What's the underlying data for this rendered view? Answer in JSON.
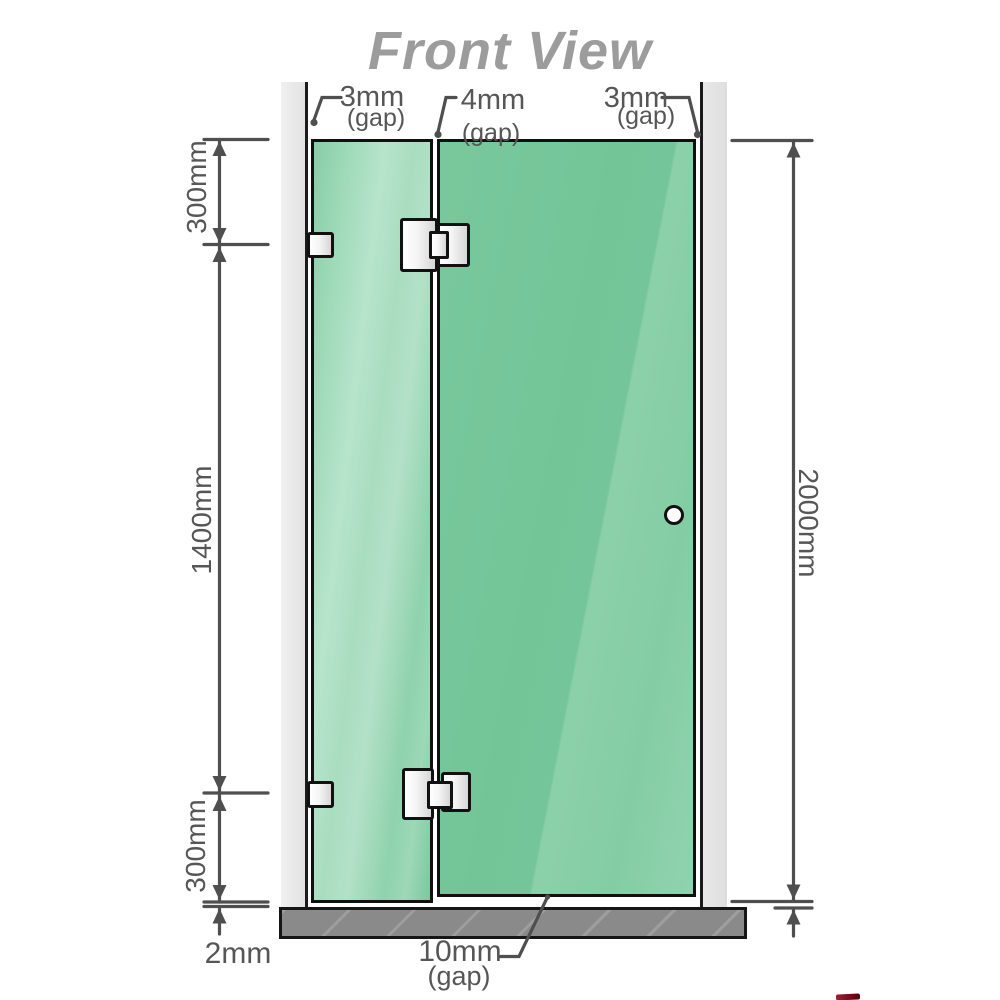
{
  "title": "Front View",
  "gaps": {
    "left": {
      "value": "3mm",
      "suffix": "(gap)"
    },
    "center": {
      "value": "4mm",
      "suffix": "(gap)"
    },
    "right": {
      "value": "3mm",
      "suffix": "(gap)"
    }
  },
  "dimensions": {
    "left_top": "300mm",
    "left_middle": "1400mm",
    "left_bottom": "300mm",
    "right_total": "2000mm",
    "floor_gap": "2mm",
    "door_bottom_gap": {
      "value": "10mm",
      "suffix": "(gap)"
    }
  },
  "colors": {
    "glass_green": "#7cc89e",
    "glass_highlight": "#b7e4cb",
    "wall_gray": "#e7e7e7",
    "base_gray": "#8a8a8a",
    "dimension_gray": "#4f4f4f",
    "label_gray": "#565656",
    "title_gray": "#9c9c9c",
    "hardware_outline": "#111111",
    "watermark_red": "#7a0f1f"
  }
}
